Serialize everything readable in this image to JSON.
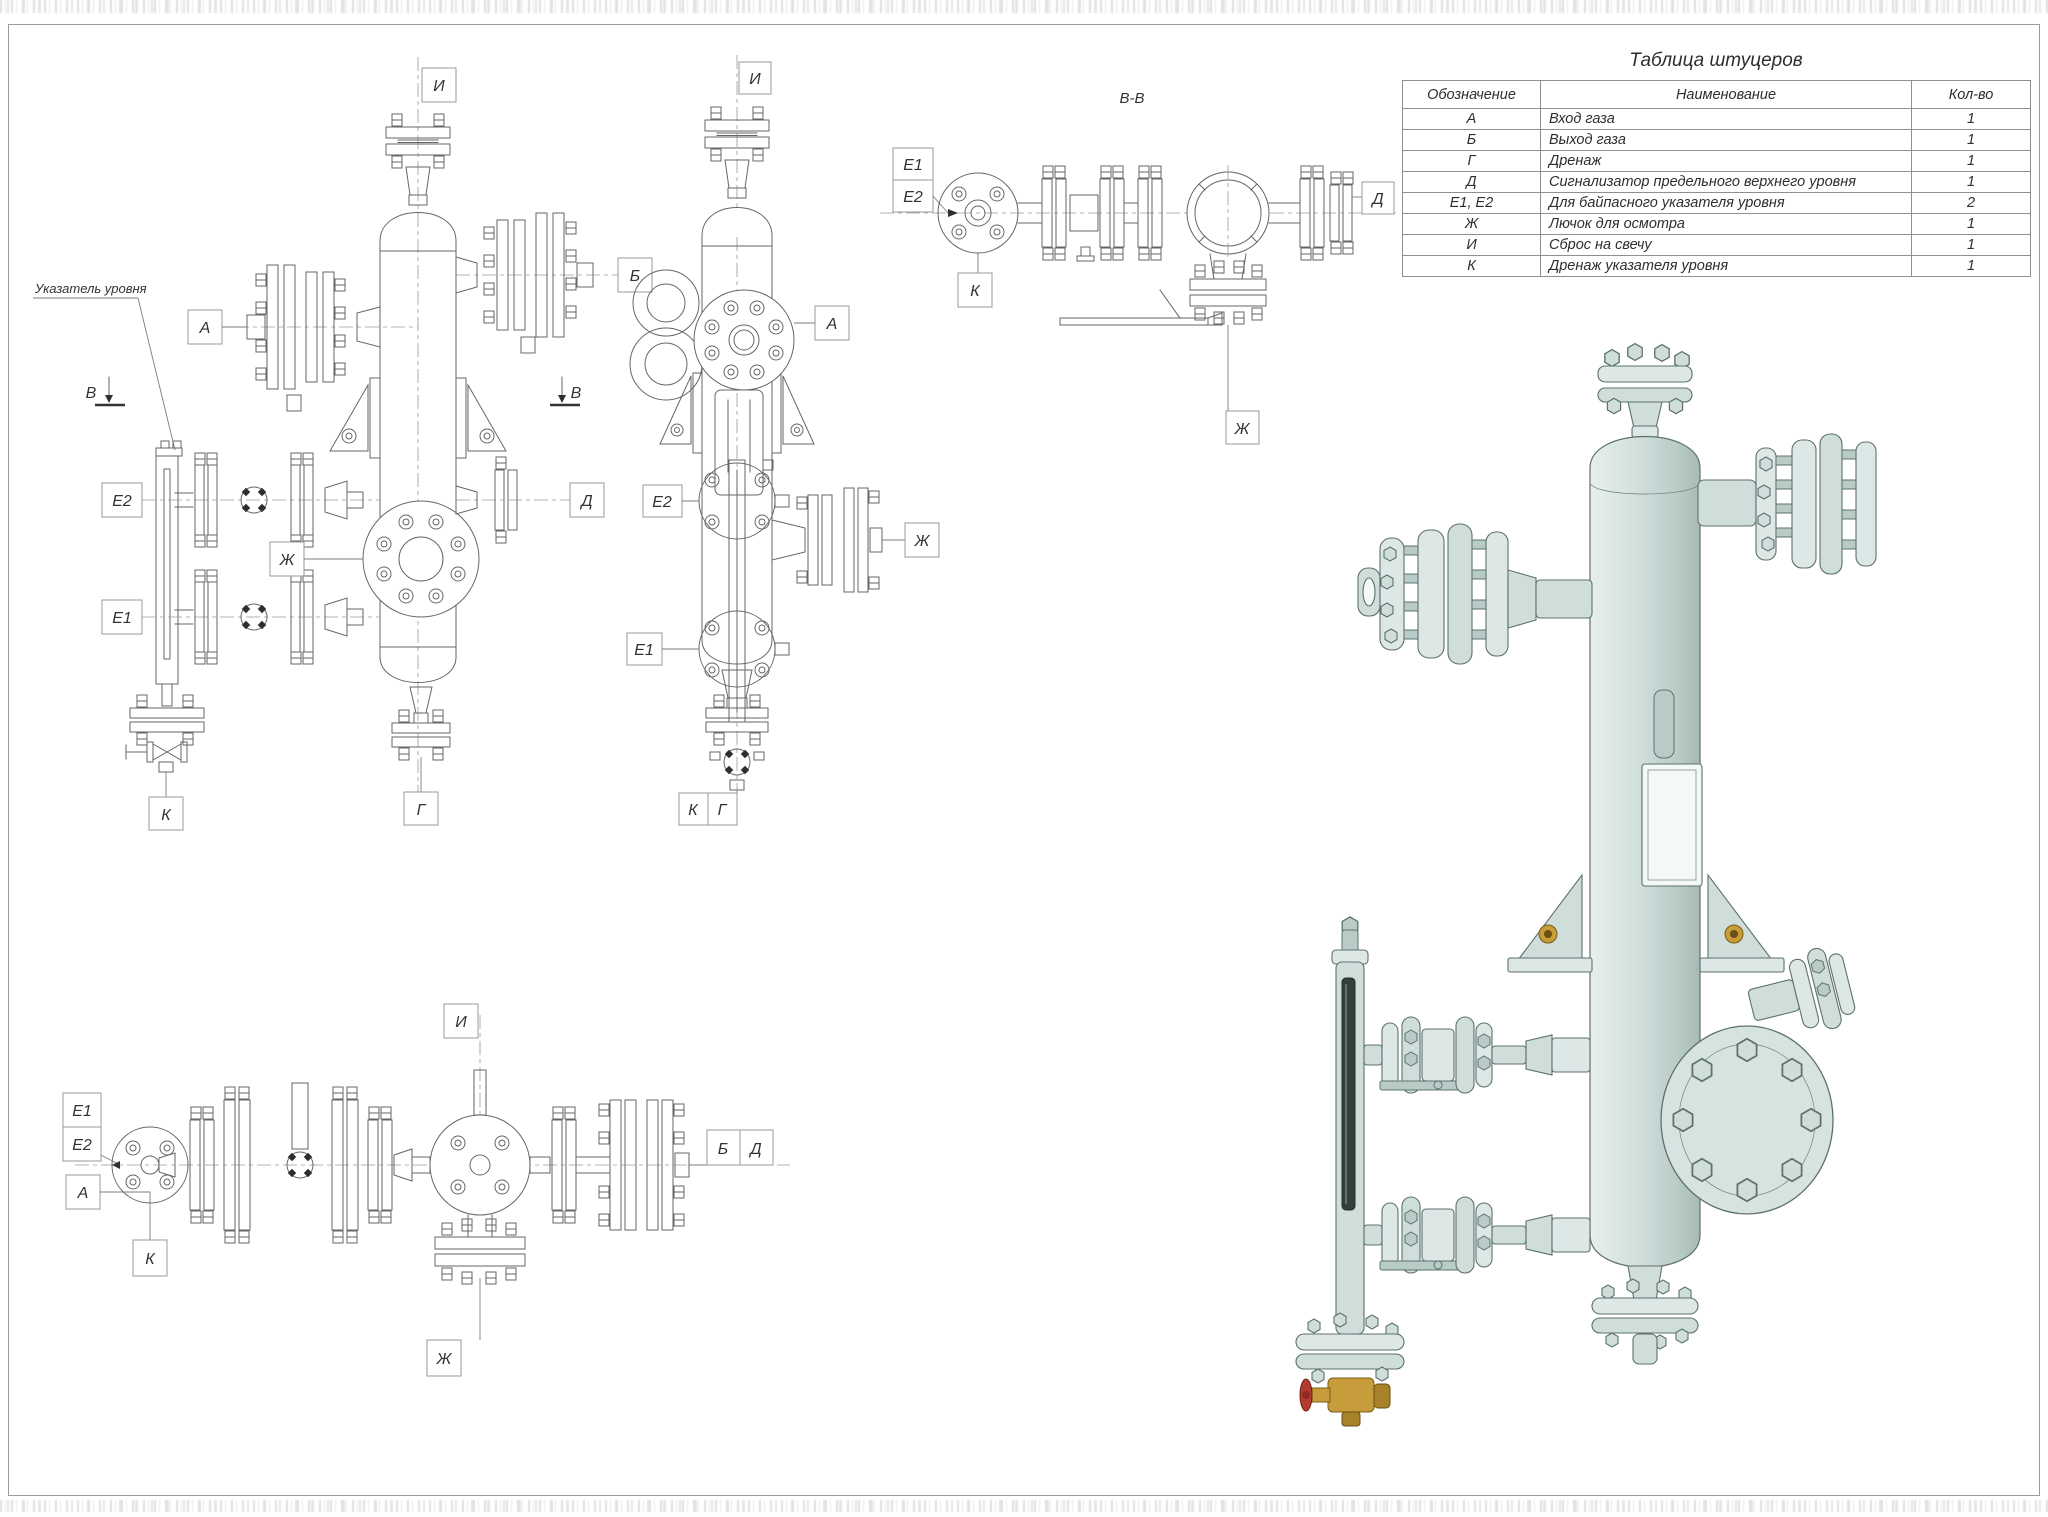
{
  "table": {
    "title": "Таблица штуцеров",
    "headers": [
      "Обозначение",
      "Наименование",
      "Кол-во"
    ],
    "rows": [
      [
        "А",
        "Вход газа",
        "1"
      ],
      [
        "Б",
        "Выход газа",
        "1"
      ],
      [
        "Г",
        "Дренаж",
        "1"
      ],
      [
        "Д",
        "Сигнализатор предельного верхнего уровня",
        "1"
      ],
      [
        "Е1, Е2",
        "Для байпасного указателя уровня",
        "2"
      ],
      [
        "Ж",
        "Лючок для осмотра",
        "1"
      ],
      [
        "И",
        "Сброс на свечу",
        "1"
      ],
      [
        "К",
        "Дренаж указателя уровня",
        "1"
      ]
    ]
  },
  "views": {
    "front": {
      "level_note": "Указатель уровня",
      "section_letter": "В",
      "labels": {
        "i": "И",
        "b": "Б",
        "a": "А",
        "e2": "Е2",
        "e1": "Е1",
        "zh": "Ж",
        "d": "Д",
        "k": "К",
        "g": "Г"
      }
    },
    "side": {
      "labels": {
        "i": "И",
        "a": "А",
        "e2": "Е2",
        "e1": "Е1",
        "zh": "Ж",
        "k": "К",
        "g": "Г"
      }
    },
    "section": {
      "title": "В-В",
      "labels": {
        "e1": "Е1",
        "e2": "Е2",
        "k": "К",
        "d": "Д",
        "zh": "Ж"
      }
    },
    "top": {
      "labels": {
        "i": "И",
        "e1": "Е1",
        "e2": "Е2",
        "a": "А",
        "k": "К",
        "b": "Б",
        "d": "Д",
        "zh": "Ж"
      }
    }
  },
  "colors": {
    "line": "#666666",
    "body_3d": "#cfdeda",
    "brass": "#c79d3c",
    "handwheel_red": "#b23a2e"
  }
}
